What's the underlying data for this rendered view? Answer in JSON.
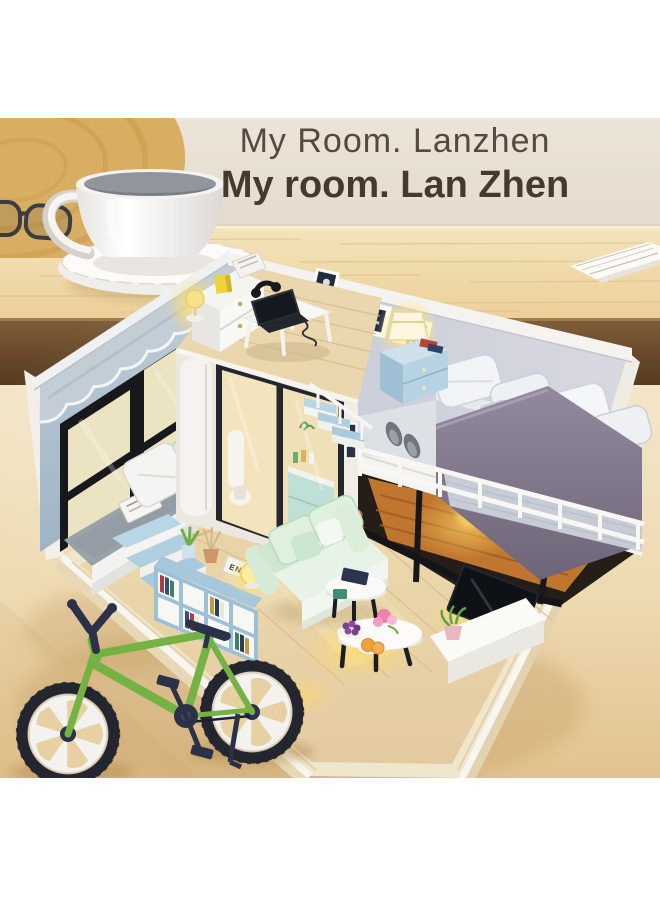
{
  "banner": {
    "title_line1": "My Room. Lanzhen",
    "title_line2": "My room. Lan Zhen",
    "text_color": "#4e4238"
  },
  "scene": {
    "description": "Product photo of a DIY miniature dollhouse loft-room kit displayed on a wooden desk with a white coffee cup and a green wooden toy bicycle in front",
    "bookshelf_spine_label": "END",
    "objects": [
      "coffee-cup-on-saucer",
      "round-wooden-board",
      "reading-glasses",
      "paper-stack",
      "miniature-loft-room-model",
      "loft-bed-with-gray-duvet",
      "lit-table-lamp",
      "laptop-desk",
      "bathroom-cube-with-glass-doors",
      "scalloped-valance-window-wall",
      "window-bench-with-pillows",
      "teddy-bear-rug",
      "cube-bookshelf-with-plants",
      "mint-green-sofa",
      "round-coffee-tables",
      "tv-console-with-plant",
      "green-toy-bicycle"
    ],
    "colors": {
      "backdrop_top": "#f3e6c8",
      "backdrop_bottom": "#e2c28f",
      "wall_beige": "#eae1d5",
      "table_wood": "#efd9a9",
      "table_edge_dark": "#6a4a2b",
      "model_wall_blue": "#a9bcca",
      "model_back_wall": "#ccd0db",
      "duvet_gray": "#7d7486",
      "sofa_mint": "#dff0e0",
      "lamp_glow": "#ffe171",
      "floor_wood": "#ead7a9",
      "bike_green": "#74b244",
      "bike_dark": "#2b3148",
      "trim_white": "#f7f6f2"
    }
  }
}
